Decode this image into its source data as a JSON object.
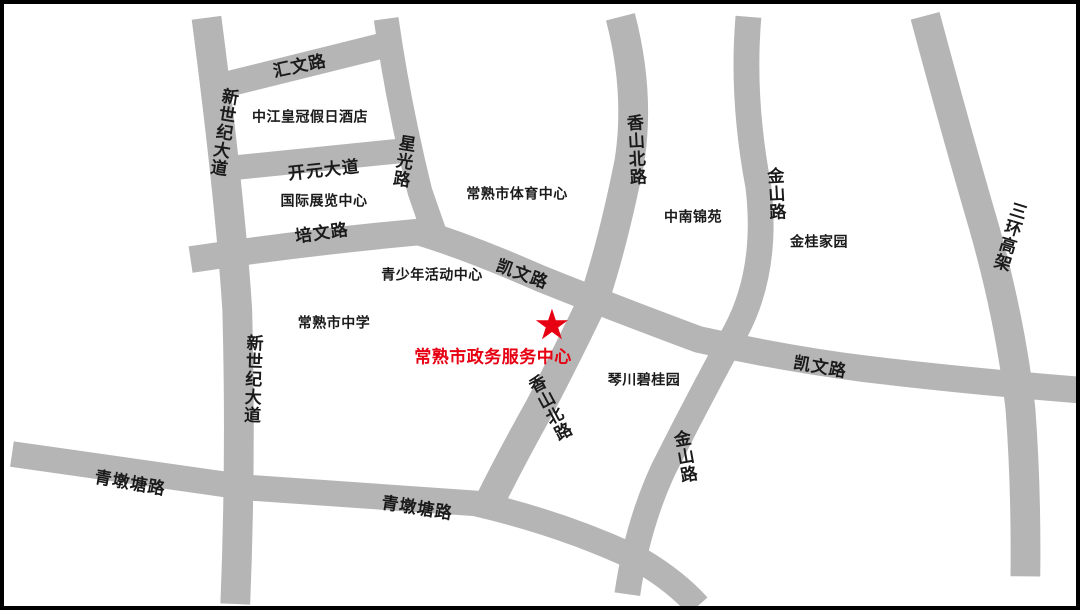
{
  "map": {
    "type": "schematic-location-map",
    "destination": {
      "name": "常熟市政务服务中心",
      "marker_glyph": "★"
    },
    "road_labels": [
      {
        "id": "huiwen-road",
        "text": "汇文路"
      },
      {
        "id": "xinshiji-avenue-north",
        "text": "新世纪大道"
      },
      {
        "id": "xingguang-road",
        "text": "星光路"
      },
      {
        "id": "kaiyuan-avenue",
        "text": "开元大道"
      },
      {
        "id": "peiwen-road",
        "text": "培文路"
      },
      {
        "id": "kaiwen-road-west",
        "text": "凯文路"
      },
      {
        "id": "xiangshan-north-road-top",
        "text": "香山北路"
      },
      {
        "id": "jinshan-road-north",
        "text": "金山路"
      },
      {
        "id": "sanhuan-elevated-road",
        "text": "三环高架"
      },
      {
        "id": "xiangshan-north-road-mid",
        "text": "香山北路"
      },
      {
        "id": "qinduntang-road-west",
        "text": "青墩塘路"
      },
      {
        "id": "xinshiji-avenue-south",
        "text": "新世纪大道"
      },
      {
        "id": "qinduntang-road-mid",
        "text": "青墩塘路"
      },
      {
        "id": "kaiwen-road-east",
        "text": "凯文路"
      },
      {
        "id": "jinshan-road-south",
        "text": "金山路"
      }
    ],
    "poi_labels": [
      {
        "id": "zhongjiang-crowne-plaza-hotel",
        "text": "中江皇冠假日酒店"
      },
      {
        "id": "international-exhibition-center",
        "text": "国际展览中心"
      },
      {
        "id": "changshu-sports-center",
        "text": "常熟市体育中心"
      },
      {
        "id": "zhongnan-jinyuan",
        "text": "中南锦苑"
      },
      {
        "id": "jingui-jiayuan",
        "text": "金桂家园"
      },
      {
        "id": "youth-activity-center",
        "text": "青少年活动中心"
      },
      {
        "id": "changshu-high-school",
        "text": "常熟市中学"
      },
      {
        "id": "qinchuan-biguiyuan",
        "text": "琴川碧桂园"
      }
    ],
    "colors": {
      "road": "#b5b5b5",
      "text": "#1a1a1a",
      "highlight": "#e60012",
      "background": "#ffffff",
      "frame": "#000000"
    }
  }
}
